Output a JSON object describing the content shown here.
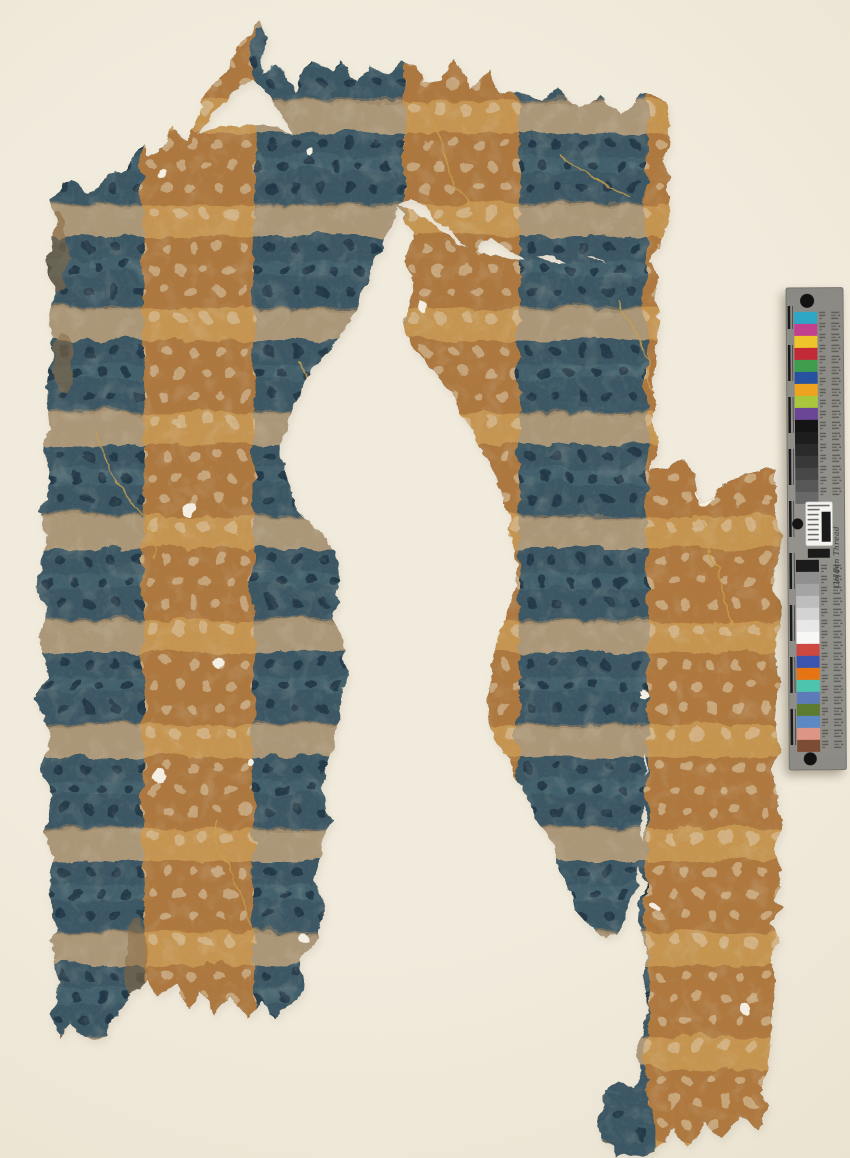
{
  "scene": {
    "description": "Archival photograph of a fragmentary plaid textile or papered artifact with horizontal dotted blue bands and vertical dotted ochre stripes, photographed on a cream backdrop with a vertical color-calibration ruler at the right edge.",
    "artifact": {
      "pattern": "horizontal blue bands with dark polka dots alternating with tan bands, crossed by vertical ochre stripes with pale polka dots",
      "condition": "torn, with large central losses and small holes"
    }
  },
  "palette": {
    "bg": "#f1ebdd",
    "bg-edge": "#e7dfcb",
    "blue": "#3a5765",
    "blue-lt": "#4e6e7b",
    "blue-dot": "#22394a",
    "tan": "#ac9879",
    "tan-dk": "#937e5f",
    "orange-dk": "#b3793d",
    "orange-lt": "#c8964f",
    "orange-dot": "#dcc199",
    "hole": "#f4efe2",
    "crack": "#c9a14e"
  },
  "color_bar": {
    "brand_text": "Golden Thread",
    "body_color": "#8f8d88",
    "tick_color": "#191919",
    "patches_top": [
      "#2ea7c6",
      "#c2418f",
      "#eec62c",
      "#c32a37",
      "#3f9e4d",
      "#27529f",
      "#eda320",
      "#a9c73d",
      "#6b4596",
      "#141414",
      "#1d1d1d",
      "#2a2a2a",
      "#383838",
      "#474747",
      "#575757",
      "#686868"
    ],
    "patches_bottom": [
      "#1b1b1b",
      "#8f8f8f",
      "#a4a4a4",
      "#bdbdbd",
      "#d3d3d3",
      "#e7e7e7",
      "#f7f7f6",
      "#cd4841",
      "#3b55af",
      "#e67413",
      "#4dc5ae",
      "#5d7bb9",
      "#5d7b2f",
      "#5c89c3",
      "#dd9585",
      "#7d4c34"
    ]
  }
}
